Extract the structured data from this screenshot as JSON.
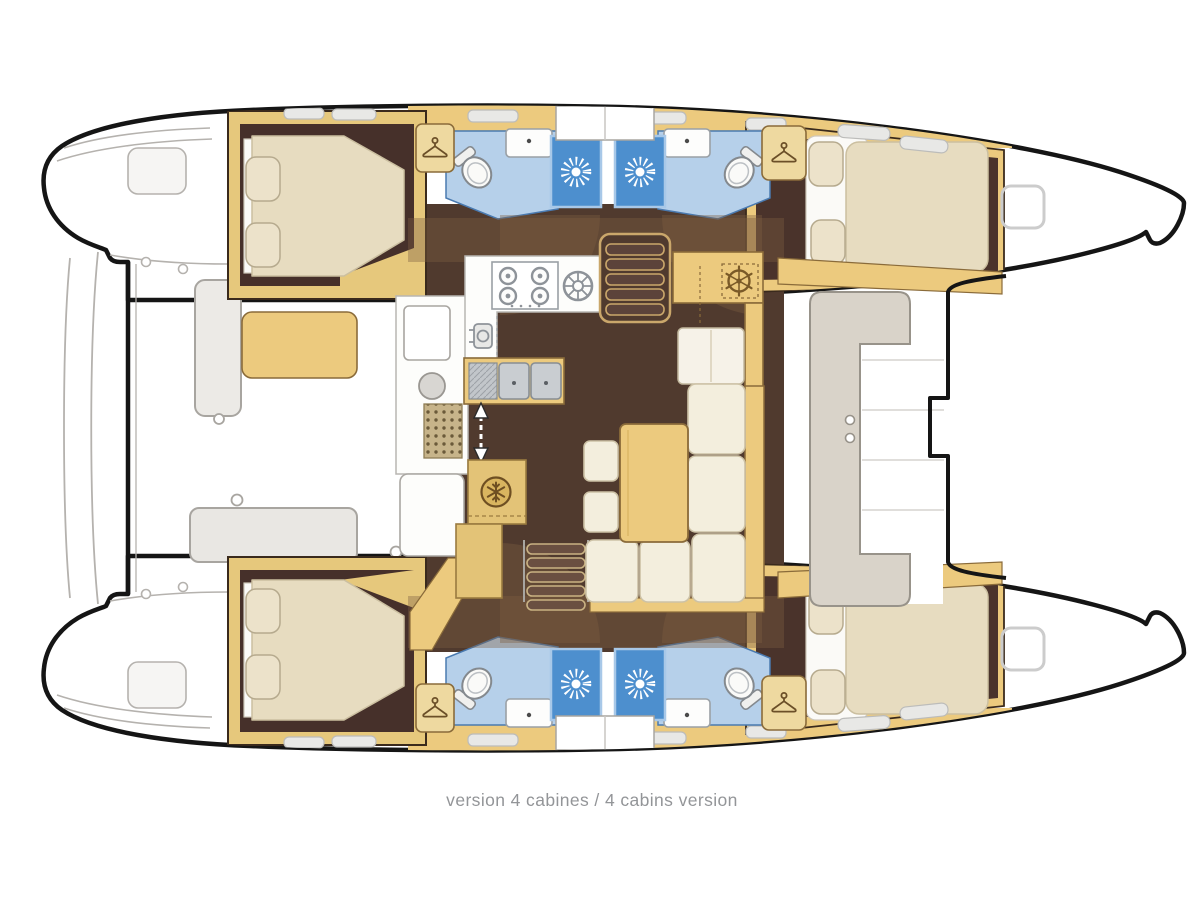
{
  "caption": {
    "text": "version 4 cabines / 4 cabins version"
  },
  "plan": {
    "type": "catamaran-floorplan-top-view",
    "variant": "4 cabins",
    "cabins_count": 4,
    "heads_count": 4,
    "shower_stalls_count": 4,
    "rooms": [
      "aft-cabin-port",
      "forward-cabin-port",
      "aft-cabin-starboard",
      "forward-cabin-starboard",
      "bathroom-port-aft",
      "bathroom-port-forward",
      "bathroom-starboard-aft",
      "bathroard-starboard-forward",
      "galley",
      "saloon-dinette",
      "chart-table",
      "aft-cockpit",
      "forward-cockpit",
      "foredeck",
      "bow-trampoline"
    ],
    "icons": {
      "hanger": "coat-hanger (wardrobe)",
      "shower": "shower-rose starburst",
      "snowflake": "refrigerator",
      "wheel": "ship-wheel (chart table)",
      "arrow": "companionway double arrow",
      "burners": "4-burner stove",
      "sinks": "double galley sink",
      "toilet": "marine toilet",
      "hatch": "deck hatch"
    },
    "colors": {
      "hull_outline": "#151515",
      "deck_line_gray": "#b3b0ac",
      "wood_trim": "#ecca7e",
      "wood_dark_edge": "#8a6b3a",
      "floor_dark_brown": "#503a2e",
      "cabin_floor": "#46302a",
      "mattress_cream": "#e7dcc0",
      "cushion_cream": "#f3eedd",
      "bathroom_floor_blue": "#b6d0ea",
      "shower_blue": "#4d8fce",
      "roof_shade": "rgba(125,95,65,0.38)",
      "caption_text": "#939598"
    }
  }
}
